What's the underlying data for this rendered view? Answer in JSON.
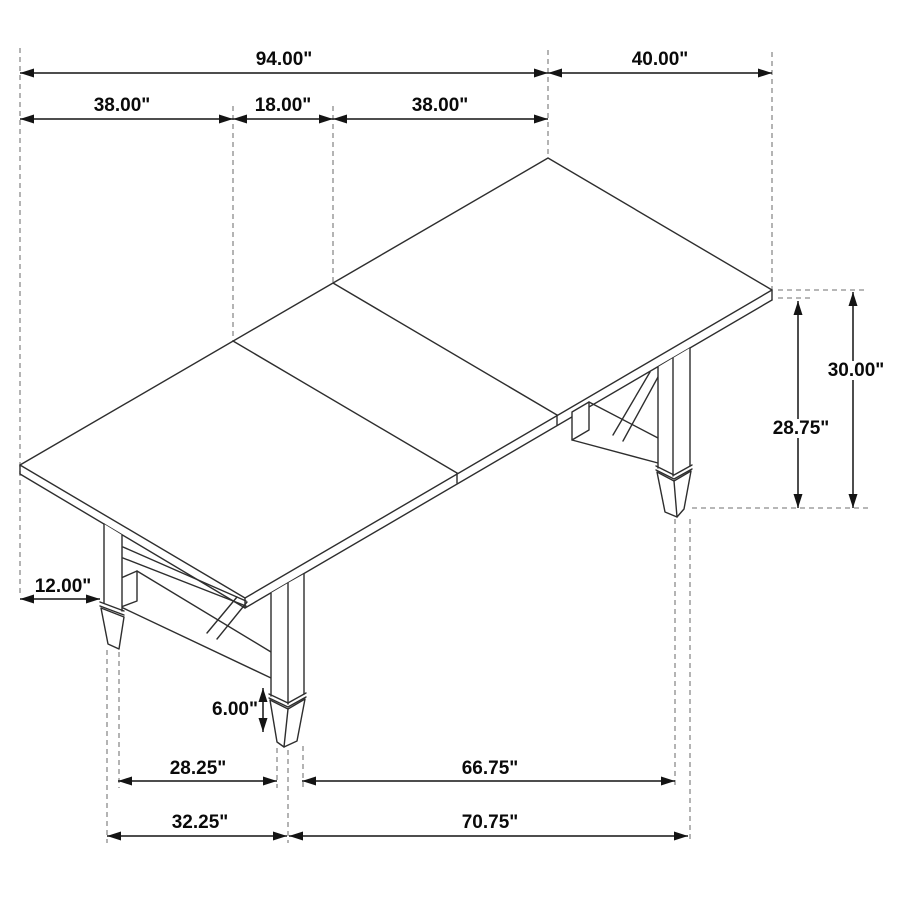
{
  "diagram": {
    "subject": "trestle-dining-table-isometric-dimension-drawing",
    "colors": {
      "background": "#ffffff",
      "line_art": "#2e2e2e",
      "dimension_line": "#141414",
      "extension_line": "#8c8c8c",
      "text": "#0a0a0a"
    }
  },
  "dims": {
    "total_length": "94.00\"",
    "extension_width": "40.00\"",
    "left_section": "38.00\"",
    "leaf_section": "18.00\"",
    "right_section": "38.00\"",
    "overhang": "12.00\"",
    "height_top": "30.00\"",
    "height_underside": "28.75\"",
    "foot_height": "6.00\"",
    "leg_span_short_inner": "28.25\"",
    "leg_span_long_inner": "66.75\"",
    "leg_span_short_outer": "32.25\"",
    "leg_span_long_outer": "70.75\""
  }
}
